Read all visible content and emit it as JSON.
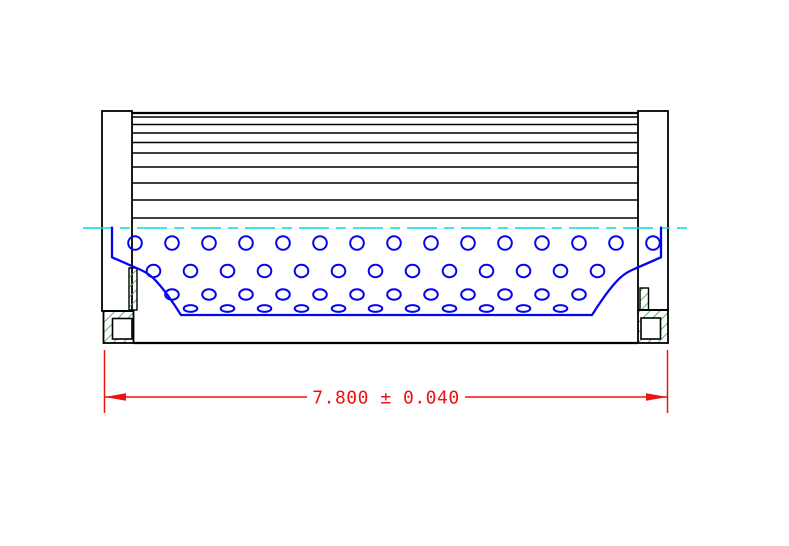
{
  "drawing": {
    "title": "filter element cross-section",
    "dimension": {
      "text": "7.800 ± 0.040",
      "value": "7.800",
      "plus_minus": "±",
      "tolerance": "0.040"
    },
    "colors": {
      "background": "#ffffff",
      "outline": "#000000",
      "perforation_blue": "#0505ee",
      "centerline_cyan": "#00dede",
      "hatch_green": "#3cae4c",
      "dimension_red": "#ef1212"
    }
  }
}
